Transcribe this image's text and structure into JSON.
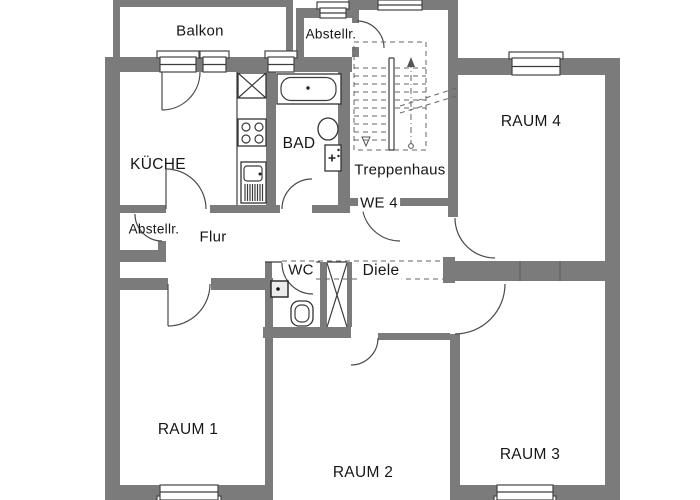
{
  "plan": {
    "unit_label": "WE 4",
    "rooms": {
      "balkon": "Balkon",
      "abstellraum_top": "Abstellr.",
      "kueche": "KÜCHE",
      "bad": "BAD",
      "treppenhaus": "Treppenhaus",
      "raum4": "RAUM 4",
      "abstellraum_lower": "Abstellr.",
      "flur": "Flur",
      "wc": "WC",
      "diele": "Diele",
      "raum1": "RAUM 1",
      "raum2": "RAUM 2",
      "raum3": "RAUM 3"
    },
    "colors": {
      "wall": "#7b7b7b",
      "line": "#3c3c3c",
      "background": "#ffffff"
    }
  }
}
